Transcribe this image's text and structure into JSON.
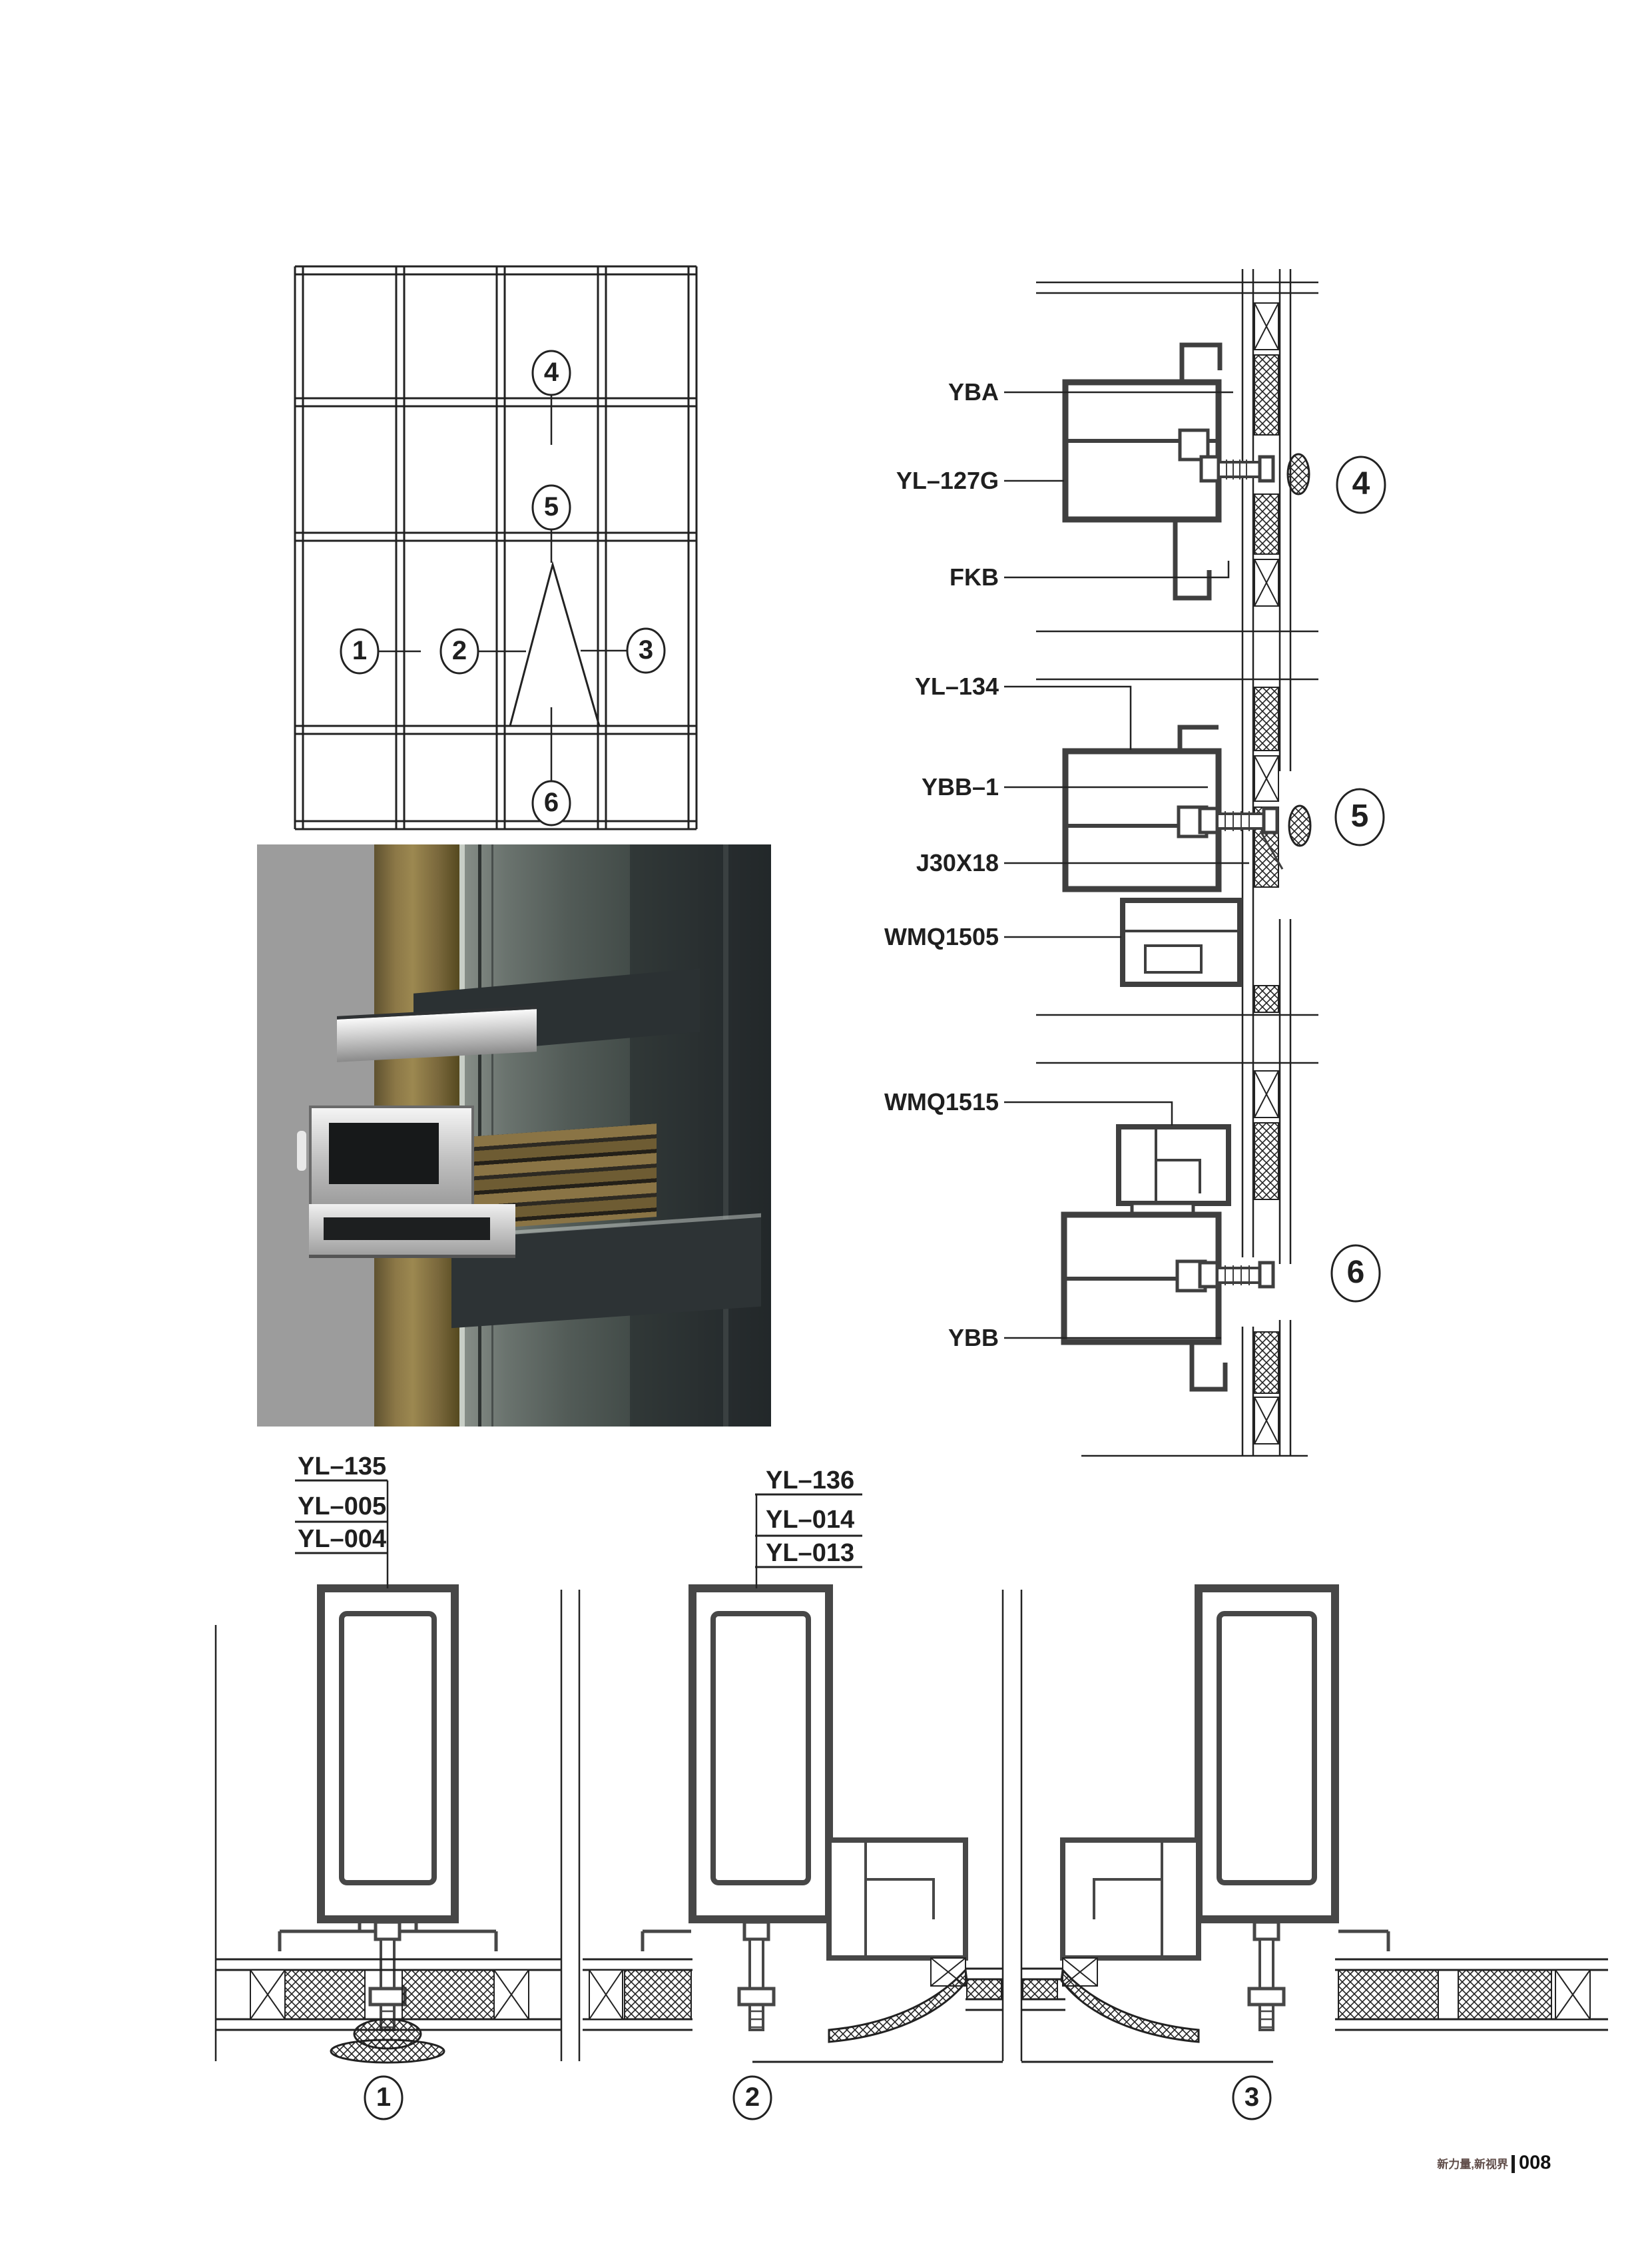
{
  "elevation": {
    "callouts": [
      "1",
      "2",
      "3",
      "4",
      "5",
      "6"
    ]
  },
  "sections_right": [
    {
      "no": "4",
      "parts": [
        "YBA",
        "YL–127G",
        "FKB"
      ]
    },
    {
      "no": "5",
      "parts": [
        "YL–134",
        "YBB–1",
        "J30X18",
        "WMQ1505"
      ]
    },
    {
      "no": "6",
      "parts": [
        "WMQ1515",
        "YBB"
      ]
    }
  ],
  "sections_bottom": [
    {
      "no": "1",
      "parts": [
        "YL–135",
        "YL–005",
        "YL–004"
      ]
    },
    {
      "no": "2",
      "parts": [
        "YL–136",
        "YL–014",
        "YL–013"
      ]
    },
    {
      "no": "3",
      "parts": []
    }
  ],
  "footer": {
    "slogan": "新力量,新视界",
    "page_number": "008"
  },
  "colors": {
    "line": "#222222",
    "profile_stroke": "#3f3f3f",
    "tube_stroke": "#474747",
    "slogan": "#5f4c48",
    "ink": "#1a1a1a",
    "render_bg": "#9c9c9c",
    "render_gold": "#8c7847",
    "render_glass": "#4a5250",
    "render_frame": "#23282a",
    "render_metal": "#d5d5d5"
  }
}
